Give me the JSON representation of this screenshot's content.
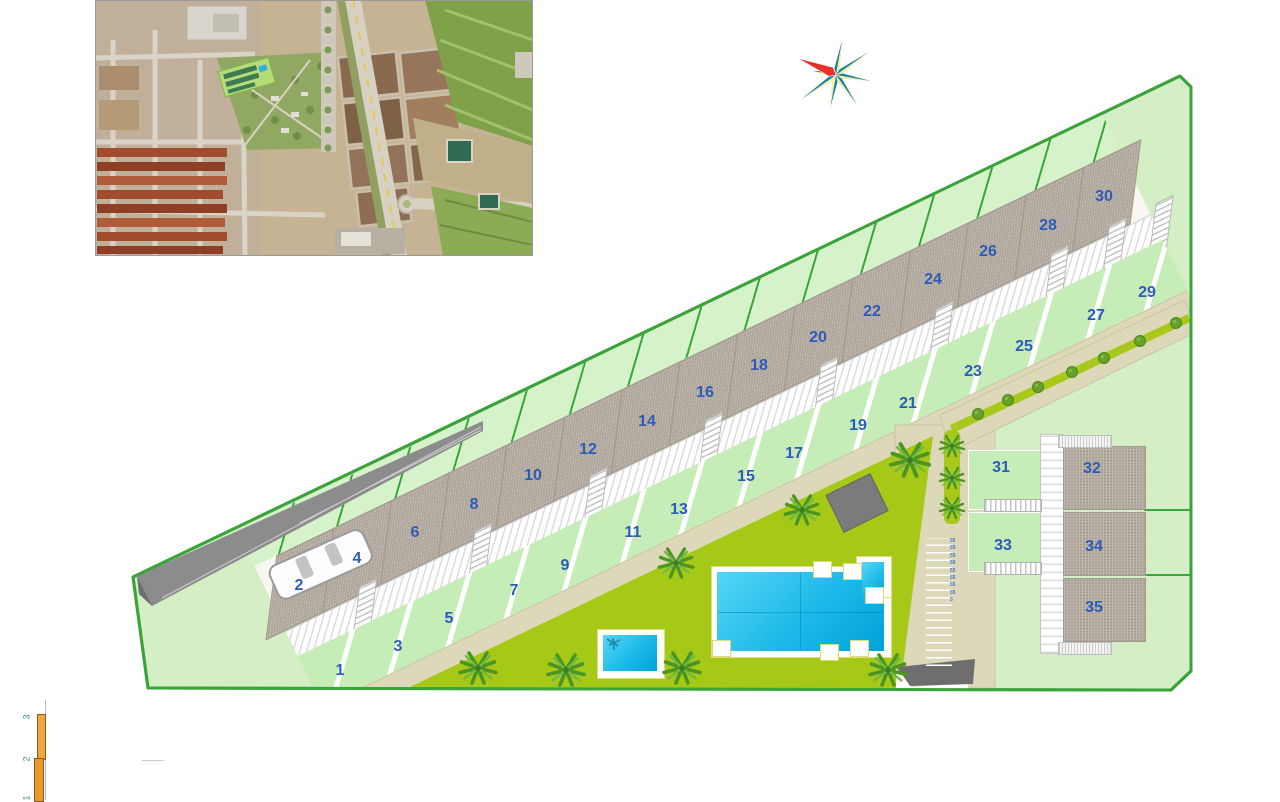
{
  "plan": {
    "plots": [
      "1",
      "2",
      "3",
      "4",
      "5",
      "6",
      "7",
      "8",
      "9",
      "10",
      "11",
      "12",
      "13",
      "14",
      "15",
      "16",
      "17",
      "18",
      "19",
      "20",
      "21",
      "22",
      "23",
      "24",
      "25",
      "26",
      "27",
      "28",
      "29",
      "30",
      "31",
      "32",
      "33",
      "34",
      "35"
    ],
    "parking_digits": "55555555555555555",
    "scale_bar": {
      "labels": [
        "3",
        "2",
        "1"
      ]
    },
    "colors": {
      "site_green": "#d4efc6",
      "boundary_green": "#3aa33a",
      "garden_green": "#c6ecb8",
      "lawn_olive": "#a5c916",
      "roof_gray": "#b3aa9f",
      "path_beige": "#ded8bb",
      "pool_cyan": "#1cb9e9",
      "label_blue": "#2d5cb8",
      "compass_red": "#e53128",
      "compass_teal": "#1f7f9f"
    }
  }
}
